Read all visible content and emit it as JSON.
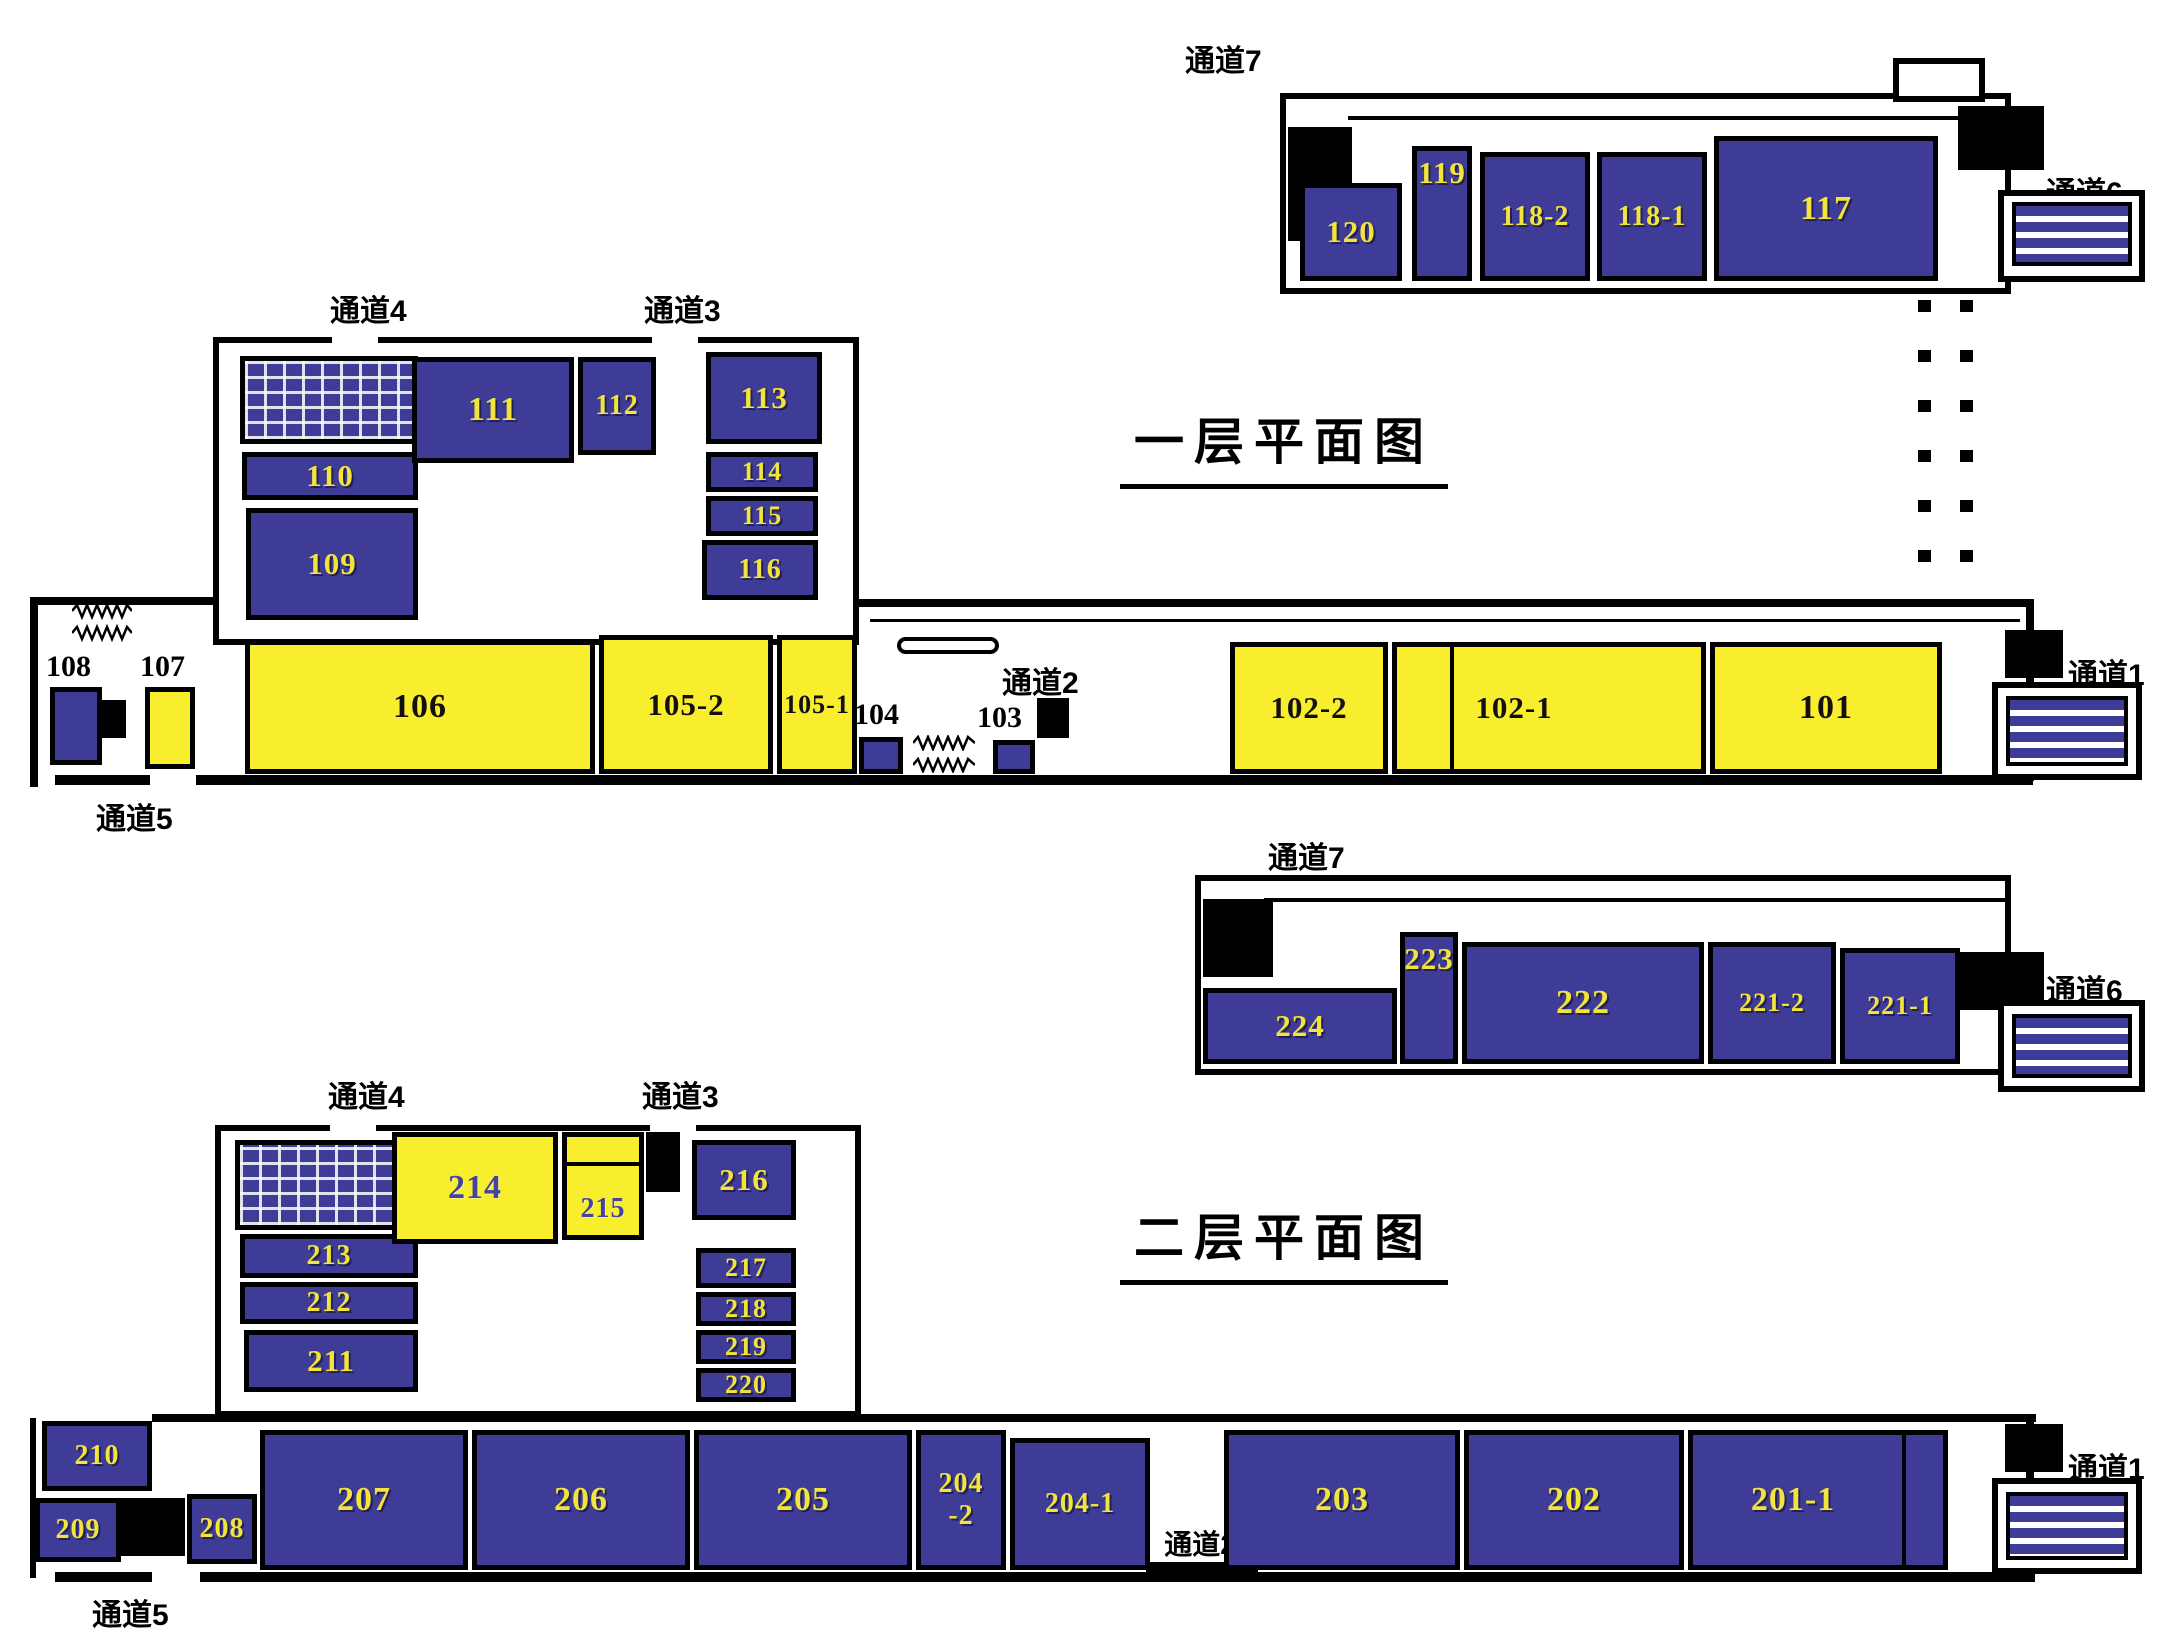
{
  "colors": {
    "room_blue": "#3e3c96",
    "room_yellow": "#f9ee2d",
    "number_yellow": "#f2e43c",
    "number_black": "#111111",
    "number_purple": "#44449e",
    "wall_black": "#000000",
    "background": "#ffffff"
  },
  "floor1": {
    "title": "一层平面图",
    "passages": {
      "p1": "通道1",
      "p2": "通道2",
      "p3": "通道3",
      "p4": "通道4",
      "p5": "通道5",
      "p6": "通道6",
      "p7": "通道7"
    },
    "rooms": {
      "r101": "101",
      "r102_1": "102-1",
      "r102_2": "102-2",
      "r103": "103",
      "r104": "104",
      "r105_1": "105-1",
      "r105_2": "105-2",
      "r106": "106",
      "r107": "107",
      "r108": "108",
      "r109": "109",
      "r110": "110",
      "r111": "111",
      "r112": "112",
      "r113": "113",
      "r114": "114",
      "r115": "115",
      "r116": "116",
      "r117": "117",
      "r118_1": "118-1",
      "r118_2": "118-2",
      "r119": "119",
      "r120": "120"
    }
  },
  "floor2": {
    "title": "二层平面图",
    "passages": {
      "p1": "通道1",
      "p2": "通道2",
      "p3": "通道3",
      "p4": "通道4",
      "p5": "通道5",
      "p6": "通道6",
      "p7": "通道7"
    },
    "rooms": {
      "r201_1": "201-1",
      "r202": "202",
      "r203": "203",
      "r204_1": "204-1",
      "r204_2_line1": "204",
      "r204_2_line2": "-2",
      "r205": "205",
      "r206": "206",
      "r207": "207",
      "r208": "208",
      "r209": "209",
      "r210": "210",
      "r211": "211",
      "r212": "212",
      "r213": "213",
      "r214": "214",
      "r215": "215",
      "r216": "216",
      "r217": "217",
      "r218": "218",
      "r219": "219",
      "r220": "220",
      "r221_1": "221-1",
      "r221_2": "221-2",
      "r222": "222",
      "r223": "223",
      "r224": "224"
    }
  }
}
